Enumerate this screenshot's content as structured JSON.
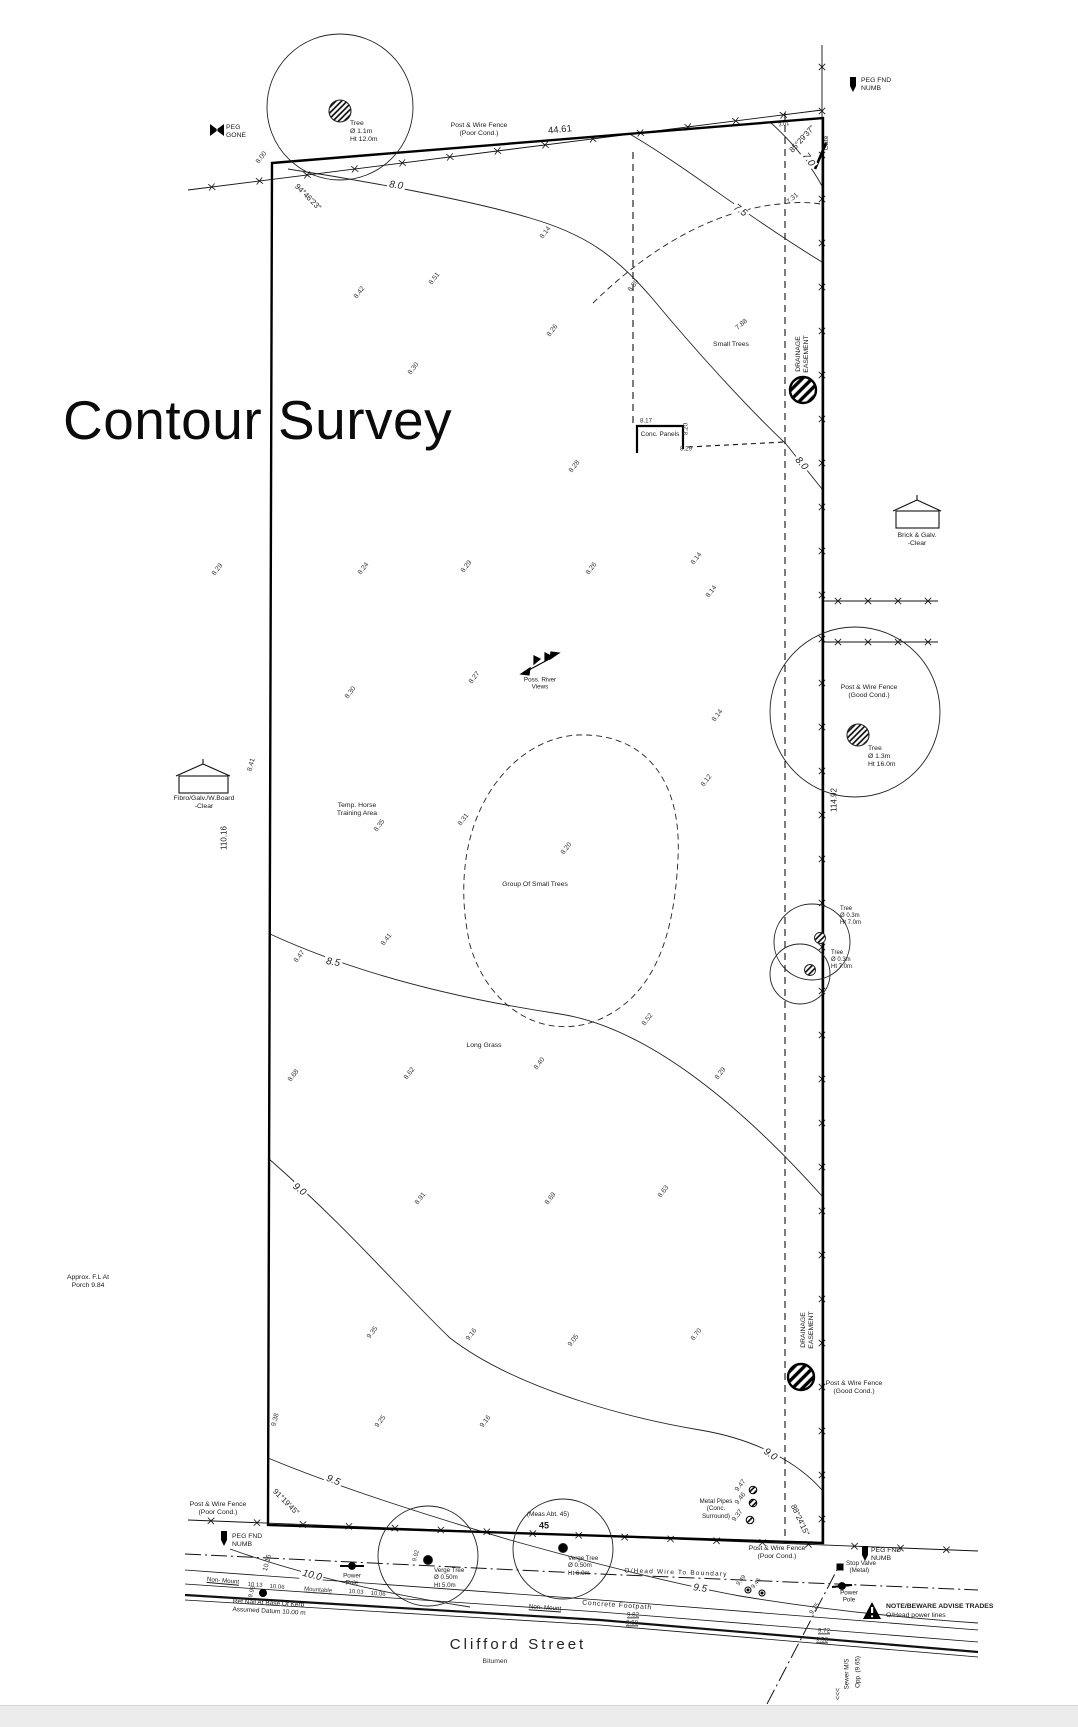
{
  "title": "Contour Survey",
  "street": {
    "name": "Clifford Street",
    "surface": "Bitumen"
  },
  "dimensions": [
    {
      "t": "44.61",
      "x": 560,
      "y": 130,
      "r": -6,
      "fs": 9.5
    },
    {
      "t": "110.16",
      "x": 224,
      "y": 838,
      "r": -90
    },
    {
      "t": "114.92",
      "x": 834,
      "y": 800,
      "r": -90
    },
    {
      "t": "3.01",
      "x": 784,
      "y": 125,
      "r": -8,
      "fs": 5.5
    }
  ],
  "bearings": [
    {
      "t": "94°46'23\"",
      "x": 308,
      "y": 197,
      "r": 45
    },
    {
      "t": "85°29'37\"",
      "x": 802,
      "y": 139,
      "r": -48
    },
    {
      "t": "91°19'45\"",
      "x": 286,
      "y": 1502,
      "r": 45
    },
    {
      "t": "88°24'15\"",
      "x": 800,
      "y": 1520,
      "r": 65
    }
  ],
  "contour_labels": [
    {
      "t": "8.0",
      "x": 396,
      "y": 186,
      "r": 8
    },
    {
      "t": "8.0",
      "x": 801,
      "y": 464,
      "r": 48
    },
    {
      "t": "7.5",
      "x": 740,
      "y": 211,
      "r": 35
    },
    {
      "t": "7.0",
      "x": 808,
      "y": 160,
      "r": 55
    },
    {
      "t": "8.5",
      "x": 333,
      "y": 963,
      "r": 10
    },
    {
      "t": "9.0",
      "x": 299,
      "y": 1190,
      "r": 38
    },
    {
      "t": "9.0",
      "x": 770,
      "y": 1455,
      "r": 35
    },
    {
      "t": "9.5",
      "x": 333,
      "y": 1481,
      "r": 22
    },
    {
      "t": "9.5",
      "x": 700,
      "y": 1589,
      "r": 8
    },
    {
      "t": "10.0",
      "x": 312,
      "y": 1576,
      "r": 14
    }
  ],
  "spots": [
    {
      "t": "8.00",
      "x": 262,
      "y": 158
    },
    {
      "t": "8.42",
      "x": 360,
      "y": 293
    },
    {
      "t": "8.51",
      "x": 435,
      "y": 279
    },
    {
      "t": "8.26",
      "x": 553,
      "y": 331
    },
    {
      "t": "8.30",
      "x": 414,
      "y": 369
    },
    {
      "t": "8.14",
      "x": 546,
      "y": 233
    },
    {
      "t": "7.88",
      "x": 742,
      "y": 325,
      "r": -40
    },
    {
      "t": "8.39",
      "x": 634,
      "y": 286
    },
    {
      "t": "7.31",
      "x": 793,
      "y": 199,
      "r": -40
    },
    {
      "t": "8.17",
      "x": 646,
      "y": 421,
      "r": 0,
      "fs": 6.2,
      "bg": 1
    },
    {
      "t": "8.20",
      "x": 686,
      "y": 429,
      "r": -90,
      "fs": 6.2
    },
    {
      "t": "8.29",
      "x": 686,
      "y": 449,
      "r": 0,
      "fs": 6.2
    },
    {
      "t": "8.28",
      "x": 575,
      "y": 467
    },
    {
      "t": "8.29",
      "x": 218,
      "y": 570
    },
    {
      "t": "8.24",
      "x": 364,
      "y": 569
    },
    {
      "t": "8.29",
      "x": 467,
      "y": 567
    },
    {
      "t": "8.26",
      "x": 592,
      "y": 569
    },
    {
      "t": "8.14",
      "x": 697,
      "y": 559
    },
    {
      "t": "8.14",
      "x": 712,
      "y": 592
    },
    {
      "t": "8.27",
      "x": 475,
      "y": 678
    },
    {
      "t": "8.30",
      "x": 351,
      "y": 693
    },
    {
      "t": "8.41",
      "x": 252,
      "y": 765,
      "r": -75
    },
    {
      "t": "8.14",
      "x": 718,
      "y": 716
    },
    {
      "t": "8.12",
      "x": 707,
      "y": 781
    },
    {
      "t": "8.35",
      "x": 380,
      "y": 826
    },
    {
      "t": "8.31",
      "x": 464,
      "y": 820
    },
    {
      "t": "8.20",
      "x": 567,
      "y": 849
    },
    {
      "t": "8.41",
      "x": 387,
      "y": 940
    },
    {
      "t": "8.47",
      "x": 300,
      "y": 957
    },
    {
      "t": "8.52",
      "x": 648,
      "y": 1020
    },
    {
      "t": "8.68",
      "x": 294,
      "y": 1076
    },
    {
      "t": "8.62",
      "x": 410,
      "y": 1074
    },
    {
      "t": "8.40",
      "x": 540,
      "y": 1064
    },
    {
      "t": "8.29",
      "x": 721,
      "y": 1074
    },
    {
      "t": "8.91",
      "x": 421,
      "y": 1199
    },
    {
      "t": "8.69",
      "x": 551,
      "y": 1199
    },
    {
      "t": "8.63",
      "x": 664,
      "y": 1192
    },
    {
      "t": "9.35",
      "x": 373,
      "y": 1333
    },
    {
      "t": "9.16",
      "x": 472,
      "y": 1335
    },
    {
      "t": "9.05",
      "x": 574,
      "y": 1341
    },
    {
      "t": "8.70",
      "x": 697,
      "y": 1335
    },
    {
      "t": "9.38",
      "x": 276,
      "y": 1420,
      "r": -75
    },
    {
      "t": "9.25",
      "x": 381,
      "y": 1422
    },
    {
      "t": "9.16",
      "x": 486,
      "y": 1422
    },
    {
      "t": "9.47",
      "x": 741,
      "y": 1486
    },
    {
      "t": "9.46",
      "x": 741,
      "y": 1499
    },
    {
      "t": "9.37",
      "x": 738,
      "y": 1516
    },
    {
      "t": "9.49",
      "x": 742,
      "y": 1581,
      "fs": 6
    },
    {
      "t": "9.46",
      "x": 757,
      "y": 1584,
      "fs": 6
    },
    {
      "t": "9.92",
      "x": 417,
      "y": 1556,
      "r": -75,
      "fs": 6
    },
    {
      "t": "9.93",
      "x": 253,
      "y": 1592,
      "r": -75,
      "fs": 6
    },
    {
      "t": "10.16",
      "x": 268,
      "y": 1563,
      "r": -75
    },
    {
      "t": "9.75",
      "x": 815,
      "y": 1609,
      "r": -55,
      "fs": 6.5
    },
    {
      "t": "9.82",
      "x": 633,
      "y": 1615,
      "r": 0,
      "fs": 6.2,
      "u": 1
    },
    {
      "t": "9.68",
      "x": 632,
      "y": 1623,
      "r": 0,
      "fs": 6.2,
      "u": 1
    },
    {
      "t": "9.72",
      "x": 824,
      "y": 1631,
      "r": 0,
      "fs": 6.2,
      "u": 1
    },
    {
      "t": "9.58",
      "x": 822,
      "y": 1640,
      "r": 0,
      "fs": 6.2,
      "u": 1
    },
    {
      "t": "10.13",
      "x": 255,
      "y": 1586,
      "r": 4,
      "fs": 6
    },
    {
      "t": "10.06",
      "x": 277,
      "y": 1588,
      "r": 4,
      "fs": 6
    },
    {
      "t": "Mountable",
      "x": 318,
      "y": 1591,
      "r": 4,
      "fs": 6,
      "u": 1
    },
    {
      "t": "10.03",
      "x": 356,
      "y": 1593,
      "r": 4,
      "fs": 6
    },
    {
      "t": "10.06",
      "x": 378,
      "y": 1595,
      "r": 4,
      "fs": 6
    }
  ],
  "annotations": [
    {
      "t": "PEG\nGONE",
      "x": 226,
      "y": 124,
      "a": "l"
    },
    {
      "t": "PEG FND\nNUMB",
      "x": 861,
      "y": 77,
      "a": "l"
    },
    {
      "t": "PEG FND\nNUMB",
      "x": 232,
      "y": 1533,
      "a": "l"
    },
    {
      "t": "PEG FND\nNUMB",
      "x": 871,
      "y": 1547,
      "a": "l"
    },
    {
      "t": "Tree\nØ 1.1m\nHt 12.0m",
      "x": 350,
      "y": 120,
      "a": "l"
    },
    {
      "t": "Post & Wire Fence\n(Poor Cond.)",
      "x": 479,
      "y": 130
    },
    {
      "t": "Gate",
      "x": 827,
      "y": 143,
      "r": -90
    },
    {
      "t": "Small Trees",
      "x": 731,
      "y": 345
    },
    {
      "t": "DRAINAGE\nEASEMENT",
      "x": 803,
      "y": 354,
      "r": -90
    },
    {
      "t": "Conc. Panels",
      "x": 660,
      "y": 435,
      "fs": 6.5
    },
    {
      "t": "Brick & Galv.\n-Clear",
      "x": 917,
      "y": 540
    },
    {
      "t": "Poss. River\nViews",
      "x": 540,
      "y": 684,
      "fs": 6.3
    },
    {
      "t": "Temp. Horse\nTraining Area",
      "x": 357,
      "y": 810
    },
    {
      "t": "Fibro/Galv./W.Board\n-Clear",
      "x": 204,
      "y": 803
    },
    {
      "t": "Post & Wire Fence\n(Good Cond.)",
      "x": 869,
      "y": 692
    },
    {
      "t": "Tree\nØ 1.3m\nHt 16.0m",
      "x": 868,
      "y": 745,
      "a": "l"
    },
    {
      "t": "Tree\nØ 0.3m\nHt 7.0m",
      "x": 840,
      "y": 906,
      "a": "l",
      "fs": 6
    },
    {
      "t": "Tree\nØ 0.3m\nHt 7.0m",
      "x": 831,
      "y": 950,
      "a": "l",
      "fs": 6
    },
    {
      "t": "Group Of Small Trees",
      "x": 535,
      "y": 885,
      "fs": 6.8
    },
    {
      "t": "Long Grass",
      "x": 484,
      "y": 1046
    },
    {
      "t": "Approx. F.L At\nPorch 9.84",
      "x": 88,
      "y": 1282
    },
    {
      "t": "DRAINAGE\nEASEMENT",
      "x": 808,
      "y": 1330,
      "r": -90
    },
    {
      "t": "Post & Wire Fence\n(Good Cond.)",
      "x": 854,
      "y": 1388
    },
    {
      "t": "Post & Wire Fence\n(Poor Cond.)",
      "x": 218,
      "y": 1509
    },
    {
      "t": "Metal Pipes\n(Conc.\nSurround)",
      "x": 716,
      "y": 1509,
      "fs": 6.3
    },
    {
      "t": "(Meas Abt. 45)",
      "x": 548,
      "y": 1515,
      "fs": 6.5
    },
    {
      "t": "45",
      "x": 544,
      "y": 1526,
      "fs": 9,
      "b": 1
    },
    {
      "t": "Post & Wire Fence\n(Poor Cond.)",
      "x": 777,
      "y": 1553
    },
    {
      "t": "Verge Tree\nØ 0.50m\nHt 5.0m",
      "x": 434,
      "y": 1567,
      "a": "l",
      "fs": 6.2
    },
    {
      "t": "Verge Tree\nØ 0.50m\nHt 6.0m",
      "x": 568,
      "y": 1555,
      "a": "l",
      "fs": 6.2
    },
    {
      "t": "Power\nPole",
      "x": 352,
      "y": 1580,
      "fs": 6.3
    },
    {
      "t": "Power\nPole",
      "x": 849,
      "y": 1597,
      "fs": 6.3
    },
    {
      "t": "Stop Valve\n  (Metal)",
      "x": 846,
      "y": 1560,
      "a": "l",
      "fs": 6.3
    },
    {
      "t": "O/Head Wire To Boundary",
      "x": 676,
      "y": 1573,
      "fs": 6.5,
      "r": 2,
      "ls": 1.2
    },
    {
      "t": "Non- Mount",
      "x": 223,
      "y": 1581,
      "fs": 6.2,
      "r": 5,
      "u": 1
    },
    {
      "t": "Non- Mount",
      "x": 545,
      "y": 1608,
      "fs": 6.2,
      "r": 4,
      "u": 1
    },
    {
      "t": "Ref Nail At Base Of Kerb\nAssumed Datum 10.00 m",
      "x": 233,
      "y": 1598,
      "a": "l",
      "fs": 6.5,
      "r": 3
    },
    {
      "t": "Concrete Footpath",
      "x": 617,
      "y": 1606,
      "fs": 6.8,
      "r": 4,
      "ls": 0.8
    },
    {
      "t": "NOTE/BEWARE ADVISE TRADES",
      "x": 886,
      "y": 1603,
      "a": "l",
      "fs": 6.8,
      "b": 1
    },
    {
      "t": "O/Head power lines",
      "x": 886,
      "y": 1612,
      "a": "l",
      "fs": 6.8
    },
    {
      "t": "Sewer M/S",
      "x": 847,
      "y": 1674,
      "r": -90,
      "fs": 6.3
    },
    {
      "t": "Opp. (9.65)",
      "x": 858,
      "y": 1672,
      "r": -90,
      "fs": 6.3
    },
    {
      "t": "<<<",
      "x": 839,
      "y": 1694,
      "r": -90,
      "fs": 7
    }
  ]
}
